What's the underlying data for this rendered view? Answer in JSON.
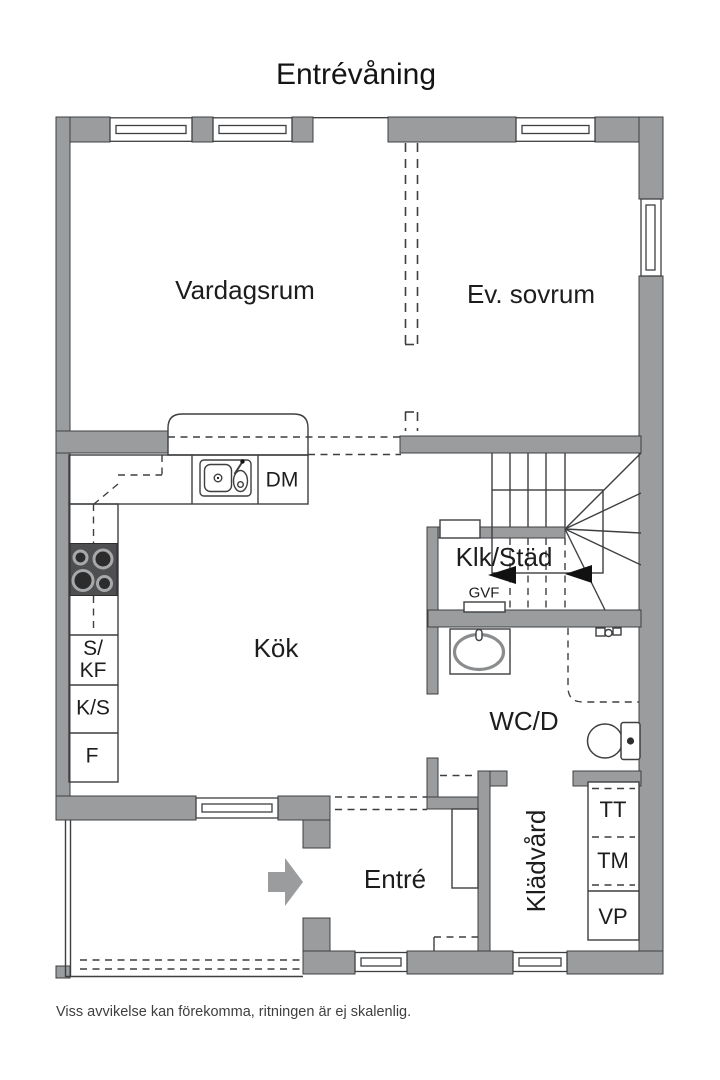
{
  "title": "Entrévåning",
  "disclaimer": "Viss avvikelse kan förekomma, ritningen är ej skalenlig.",
  "rooms": {
    "vardagsrum": "Vardagsrum",
    "ev_sovrum": "Ev. sovrum",
    "kok": "Kök",
    "klk_stad": "Klk/Städ",
    "wc_d": "WC/D",
    "entre": "Entré",
    "kladvard": "Klädvård"
  },
  "labels": {
    "dm": "DM",
    "s_kf_top": "S/",
    "s_kf_bottom": "KF",
    "k_s": "K/S",
    "f": "F",
    "gvf": "GVF",
    "tt": "TT",
    "tm": "TM",
    "vp": "VP"
  },
  "colors": {
    "wall": "#9a9c9e",
    "line": "#3e3f41",
    "text": "#1d1d1d",
    "stove": "#4e4f51",
    "arrow": "#9a9c9e"
  }
}
